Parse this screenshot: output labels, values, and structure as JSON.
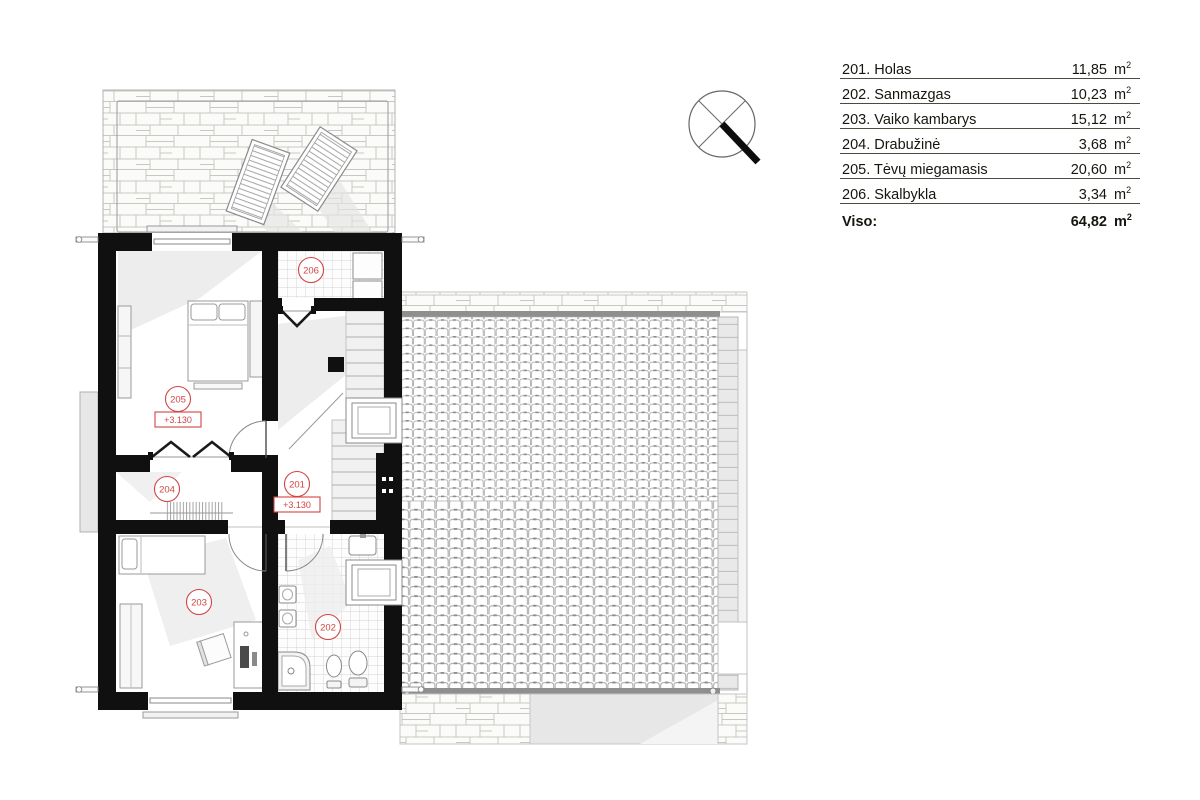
{
  "legend": {
    "rows": [
      {
        "label": "201. Holas",
        "value": "11,85"
      },
      {
        "label": "202. Sanmazgas",
        "value": "10,23"
      },
      {
        "label": "203. Vaiko kambarys",
        "value": "15,12"
      },
      {
        "label": "204. Drabužinė",
        "value": "3,68"
      },
      {
        "label": "205. Tėvų miegamasis",
        "value": "20,60"
      },
      {
        "label": "206. Skalbykla",
        "value": "3,34"
      }
    ],
    "total": {
      "label": "Viso:",
      "value": "64,82"
    },
    "unit_base": "m",
    "unit_exp": "2"
  },
  "plan": {
    "room_labels": {
      "r201": "201",
      "r202": "202",
      "r203": "203",
      "r204": "204",
      "r205": "205",
      "r206": "206"
    },
    "elevations": {
      "bedroom": "+3.130",
      "hall": "+3.130"
    },
    "colors": {
      "wall": "#101010",
      "accent_red": "#d24444",
      "roof_line": "#a8a8a8"
    },
    "icons": [
      "north-arrow-icon",
      "skylight-icon",
      "stairs-icon",
      "door-swing-icon"
    ]
  }
}
